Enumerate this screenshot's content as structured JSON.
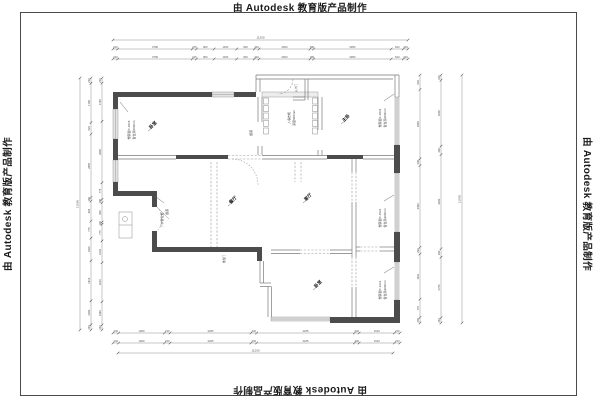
{
  "watermark": {
    "prefix": "由",
    "brand": "Autodesk",
    "suffix": "教育版产品制作"
  },
  "plan": {
    "rooms": [
      {
        "s": "卧室",
        "x": 154,
        "y": 126,
        "rot": -45,
        "size": 4.4,
        "name": "room-label-bedroom-topleft"
      },
      {
        "s": "主卧",
        "x": 347,
        "y": 119,
        "rot": -45,
        "size": 4.4,
        "name": "room-label-master-bedroom"
      },
      {
        "s": "餐厅",
        "x": 234,
        "y": 201,
        "rot": -45,
        "size": 4.4,
        "name": "room-label-dining"
      },
      {
        "s": "客厅",
        "x": 309,
        "y": 198,
        "rot": -45,
        "size": 4.4,
        "name": "room-label-living"
      },
      {
        "s": "卧室",
        "x": 319,
        "y": 285,
        "rot": -45,
        "size": 4.4,
        "name": "room-label-bedroom-bottom"
      }
    ],
    "annotations": [
      {
        "s": "塑钢窗C-1815",
        "x": 130,
        "y": 130,
        "rot": -90,
        "size": 3,
        "name": "annotation-window-left"
      },
      {
        "s": "窗台高500mm",
        "x": 135,
        "y": 130,
        "rot": -90,
        "size": 3,
        "name": "annotation-sill-left"
      },
      {
        "s": "入墙衣柜",
        "x": 290,
        "y": 118,
        "rot": -90,
        "size": 3,
        "name": "annotation-closet"
      },
      {
        "s": "深度600mm",
        "x": 295,
        "y": 118,
        "rot": -90,
        "size": 3,
        "name": "annotation-closet-depth"
      },
      {
        "s": "塑钢窗C-1824",
        "x": 381,
        "y": 118,
        "rot": -90,
        "size": 3,
        "name": "annotation-window-topright"
      },
      {
        "s": "窗台高900mm",
        "x": 386,
        "y": 118,
        "rot": -90,
        "size": 3,
        "name": "annotation-sill-topright"
      },
      {
        "s": "塑钢窗C-1521",
        "x": 381,
        "y": 218,
        "rot": -90,
        "size": 3,
        "name": "annotation-window-midright"
      },
      {
        "s": "窗台高900mm",
        "x": 386,
        "y": 218,
        "rot": -90,
        "size": 3,
        "name": "annotation-sill-midright"
      },
      {
        "s": "塑钢窗C-1221",
        "x": 381,
        "y": 290,
        "rot": -90,
        "size": 3,
        "name": "annotation-window-bottomright"
      },
      {
        "s": "窗台高900mm",
        "x": 386,
        "y": 290,
        "rot": -90,
        "size": 3,
        "name": "annotation-sill-bottomright"
      },
      {
        "s": "下水管位置",
        "x": 163,
        "y": 220,
        "rot": -90,
        "size": 3,
        "name": "annotation-pipe"
      },
      {
        "s": "烟道",
        "x": 168,
        "y": 212,
        "rot": -90,
        "size": 3,
        "name": "annotation-flue"
      },
      {
        "s": "烟道",
        "x": 252,
        "y": 133,
        "rot": -90,
        "size": 3,
        "name": "annotation-flue-2"
      },
      {
        "s": "入户门",
        "x": 297,
        "y": 88,
        "rot": -90,
        "size": 2.8,
        "name": "annotation-entry-door"
      },
      {
        "s": "推拉门",
        "x": 225,
        "y": 259,
        "rot": -90,
        "size": 2.8,
        "name": "annotation-sliding-door"
      }
    ],
    "leaders": [
      [
        128,
        112,
        120,
        102
      ],
      [
        384,
        101,
        394,
        94
      ],
      [
        384,
        201,
        394,
        195
      ],
      [
        384,
        273,
        394,
        267
      ],
      [
        164,
        203,
        155,
        196
      ],
      [
        148,
        131,
        153,
        127
      ],
      [
        341,
        124,
        346,
        120
      ],
      [
        228,
        206,
        233,
        202
      ],
      [
        303,
        203,
        308,
        199
      ],
      [
        313,
        290,
        318,
        286
      ]
    ],
    "dims": [
      {
        "type": "h",
        "y": 40,
        "x1": 113,
        "x2": 408,
        "overall": "11200",
        "name": "dim-top-overall"
      },
      {
        "type": "h",
        "y": 49,
        "x1": 113,
        "x2": 408,
        "labels": [
          "240",
          "3796",
          "215",
          "900",
          "1150",
          "900",
          "240",
          "2600",
          "180",
          "3950",
          "620",
          "240"
        ],
        "name": "dim-top-row1"
      },
      {
        "type": "h",
        "y": 59,
        "x1": 113,
        "x2": 408,
        "labels": [
          "240",
          "3796",
          "215",
          "900",
          "1150",
          "900",
          "240",
          "2600",
          "180",
          "3950",
          "620",
          "240"
        ],
        "name": "dim-top-row2"
      },
      {
        "type": "h",
        "y": 333,
        "x1": 113,
        "x2": 400,
        "labels": [
          "240",
          "1960",
          "240",
          "3465",
          "240",
          "4185",
          "200",
          "1510",
          "240"
        ],
        "name": "dim-bottom-row1"
      },
      {
        "type": "h",
        "y": 343,
        "x1": 113,
        "x2": 400,
        "labels": [
          "240",
          "1960",
          "240",
          "3465",
          "240",
          "4185",
          "200",
          "1510",
          "240"
        ],
        "name": "dim-bottom-row2"
      },
      {
        "type": "h",
        "y": 353,
        "x1": 118,
        "x2": 393,
        "overall": "11200",
        "name": "dim-bottom-overall"
      },
      {
        "type": "v",
        "x": 80,
        "y1": 78,
        "y2": 330,
        "overall": "11065",
        "name": "dim-left-overall"
      },
      {
        "type": "v",
        "x": 91,
        "y1": 78,
        "y2": 330,
        "labels": [
          "240",
          "1780",
          "520",
          "2865",
          "160",
          "905",
          "775",
          "1020",
          "1815",
          "1080",
          "240"
        ],
        "name": "dim-left-row1"
      },
      {
        "type": "v",
        "x": 102,
        "y1": 78,
        "y2": 330,
        "labels": [
          "240",
          "1780",
          "2865",
          "775",
          "160",
          "905",
          "100",
          "775",
          "1020",
          "1815",
          "1080",
          "240"
        ],
        "name": "dim-left-row2"
      },
      {
        "type": "v",
        "x": 420,
        "y1": 75,
        "y2": 323,
        "labels": [
          "620",
          "2955",
          "290",
          "3490",
          "290",
          "1931",
          "775",
          "240"
        ],
        "name": "dim-right-row1"
      },
      {
        "type": "v",
        "x": 441,
        "y1": 75,
        "y2": 323,
        "labels": [
          "240",
          "3000",
          "390",
          "4290",
          "390",
          "2755",
          "240"
        ],
        "name": "dim-right-row2"
      },
      {
        "type": "v",
        "x": 462,
        "y1": 75,
        "y2": 323,
        "overall": "11065",
        "name": "dim-right-overall"
      }
    ]
  }
}
